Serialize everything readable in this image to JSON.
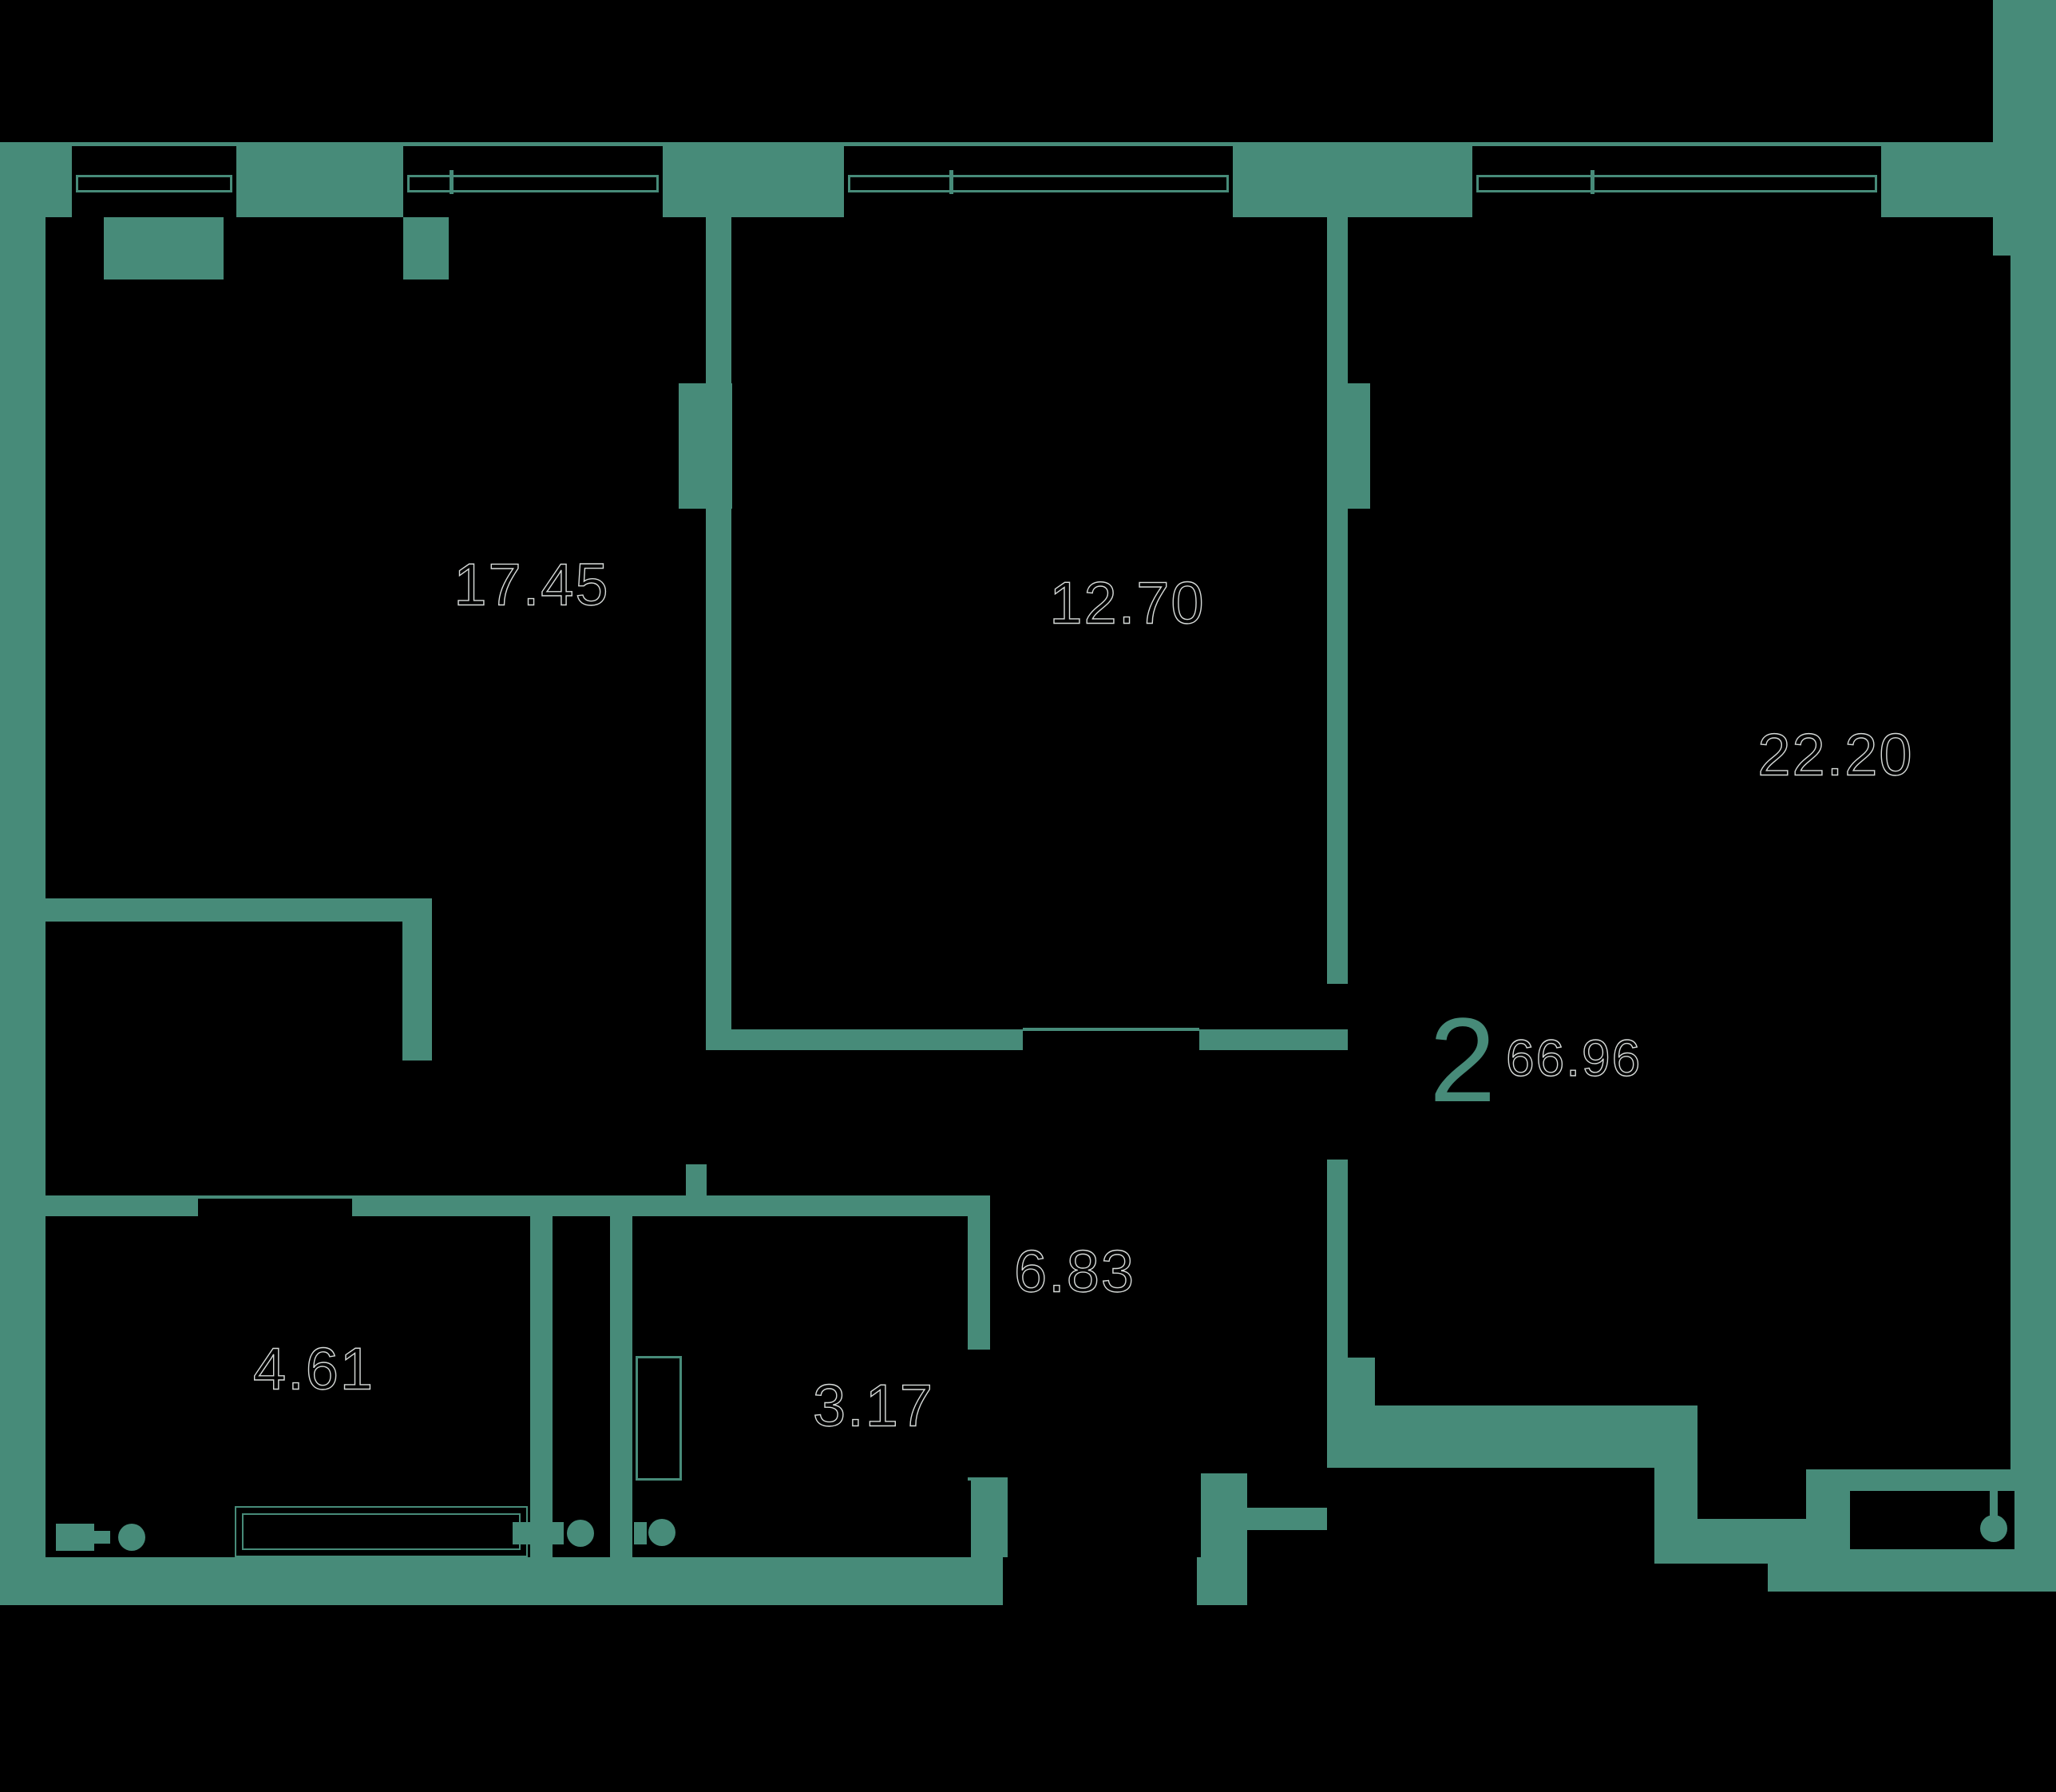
{
  "rooms": [
    {
      "name": "room-1",
      "area": "17.45"
    },
    {
      "name": "room-2",
      "area": "12.70"
    },
    {
      "name": "living-room",
      "area": "22.20"
    },
    {
      "name": "bathroom",
      "area": "4.61"
    },
    {
      "name": "wc",
      "area": "3.17"
    },
    {
      "name": "hall",
      "area": "6.83"
    }
  ],
  "summary": {
    "rooms_count": "2",
    "total_area": "66.96"
  },
  "colors": {
    "walls": "#478b79",
    "background": "#000000",
    "label_outline": "#d6dad8"
  },
  "icons": {
    "window-icon": "double-line frame in wall opening",
    "bathtub-icon": "nested thin rectangles",
    "toilet-icon": "tank rectangle + bowl circle",
    "washing-machine-icon": "thin outlined rectangle",
    "pipe-riser-icon": "filled circle",
    "drain-icon": "circle with stem in exterior wall"
  }
}
